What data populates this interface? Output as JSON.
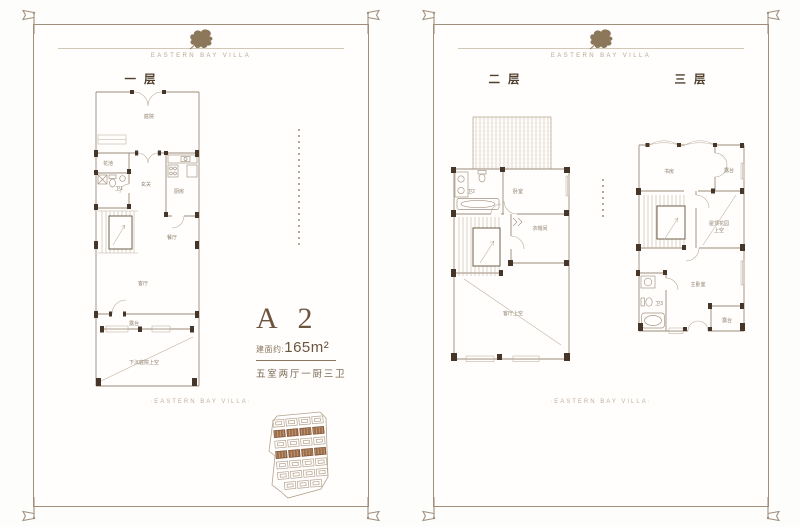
{
  "brand": {
    "tagline": "EASTERN BAY VILLA",
    "footer_tagline": "·EASTERN BAY VILLA·"
  },
  "unit": {
    "name": "A 2",
    "area_prefix": "建面约:",
    "area_value": "165m²",
    "layout_desc": "五室两厅一厨三卫"
  },
  "floors": {
    "floor1": {
      "title": "一层",
      "rooms": {
        "courtyard": "庭院",
        "flower_bed": "花池",
        "bath1": "卫1",
        "foyer": "玄关",
        "kitchen": "厨房",
        "dining": "餐厅",
        "living": "客厅",
        "terrace": "露台",
        "sunken_courtyard_void": "下沉庭院上空"
      }
    },
    "floor2": {
      "title": "二层",
      "rooms": {
        "bath2": "卫2",
        "bedroom": "卧室",
        "cloakroom": "衣帽间",
        "living_void": "客厅上空"
      }
    },
    "floor3": {
      "title": "三层",
      "rooms": {
        "study": "书房",
        "terrace_upper": "露台",
        "roof_garden_line1": "屋顶花园",
        "roof_garden_line2": "上空",
        "master_bedroom": "主卧室",
        "bath3": "卫3",
        "terrace_lower": "露台"
      }
    }
  },
  "colors": {
    "frame": "#a18f7c",
    "wall": "#9b8b79",
    "pier": "#463529",
    "room_label": "#8d7d6a",
    "accent_text": "#6d543f",
    "leaf": "#8d775a",
    "unit_highlight": "#9c6e4c",
    "caption": "#b7a690"
  }
}
